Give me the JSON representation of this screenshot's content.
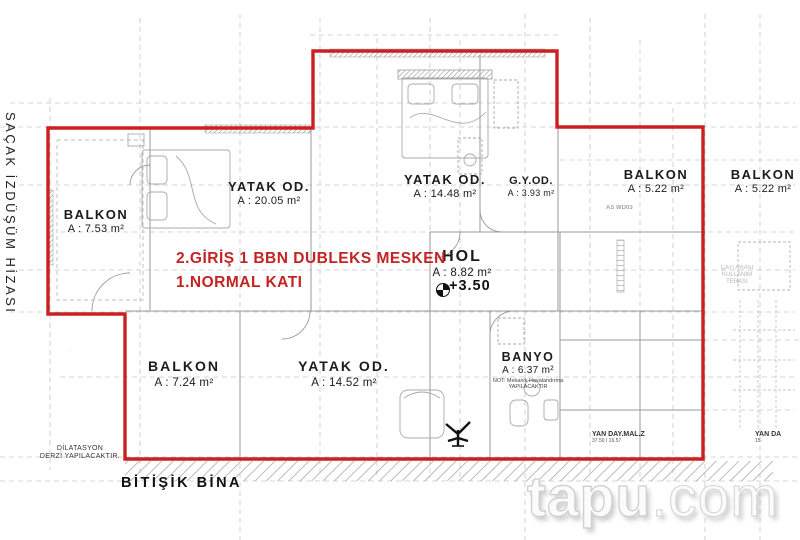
{
  "colors": {
    "boundary_red": "#cb2020",
    "annotation_red": "#c42323",
    "sketch_gray": "#9a9a9a",
    "grid_gray": "#c6c6c6",
    "text_black": "#1b1b1b",
    "watermark_fill": "#fbfbfb",
    "watermark_stroke": "#cfcfcf"
  },
  "left_margin": {
    "vertical_label": "SAÇAK İZDÜŞÜM HİZASI"
  },
  "annotation": {
    "line1": "2.GİRİŞ 1 BBN DUBLEKS MESKEN",
    "line2": "1.NORMAL KATI"
  },
  "elevation": {
    "label": "+3.50"
  },
  "rooms": [
    {
      "id": "balkon-left",
      "name": "BALKON",
      "area": "A : 7.53 m²"
    },
    {
      "id": "yatak-od-left",
      "name": "YATAK OD.",
      "area": "A : 20.05 m²"
    },
    {
      "id": "yatak-od-top",
      "name": "YATAK OD.",
      "area": "A : 14.48 m²"
    },
    {
      "id": "gy-od",
      "name": "G.Y.OD.",
      "area": "A : 3.93 m²"
    },
    {
      "id": "balkon-top-right",
      "name": "BALKON",
      "area": "A : 5.22 m²"
    },
    {
      "id": "balkon-outside",
      "name": "BALKON",
      "area": "A : 5.22 m²"
    },
    {
      "id": "hol",
      "name": "HOL",
      "area": "A : 8.82 m²"
    },
    {
      "id": "banyo",
      "name": "BANYO",
      "area": "A : 6.37 m²",
      "note_line1": "NOT: Mekanik Havalandırma",
      "note_line2": "YAPILACAKTIR"
    },
    {
      "id": "balkon-bottom",
      "name": "BALKON",
      "area": "A : 7.24 m²"
    },
    {
      "id": "yatak-od-bottom",
      "name": "YATAK OD.",
      "area": "A : 14.52 m²"
    }
  ],
  "bottom": {
    "dilatasyon_line1": "DİLATASYON",
    "dilatasyon_line2": "DERZİ YAPILACAKTIR.",
    "adjacent_building": "BİTİŞİK BİNA"
  },
  "small_notes": {
    "as_label": "AS WD03",
    "yan_day_left": "YAN DAY.MAL.Z",
    "yan_day_left_sub": "37.50 / 16.57",
    "yan_day_right": "YAN DA",
    "yan_day_right_sub": "15.",
    "attic_note_lines": [
      "ÇATI ARASI",
      "KULLANIM",
      "TERASI"
    ]
  },
  "watermark": {
    "part1": "tapu",
    "part2": ".com"
  }
}
